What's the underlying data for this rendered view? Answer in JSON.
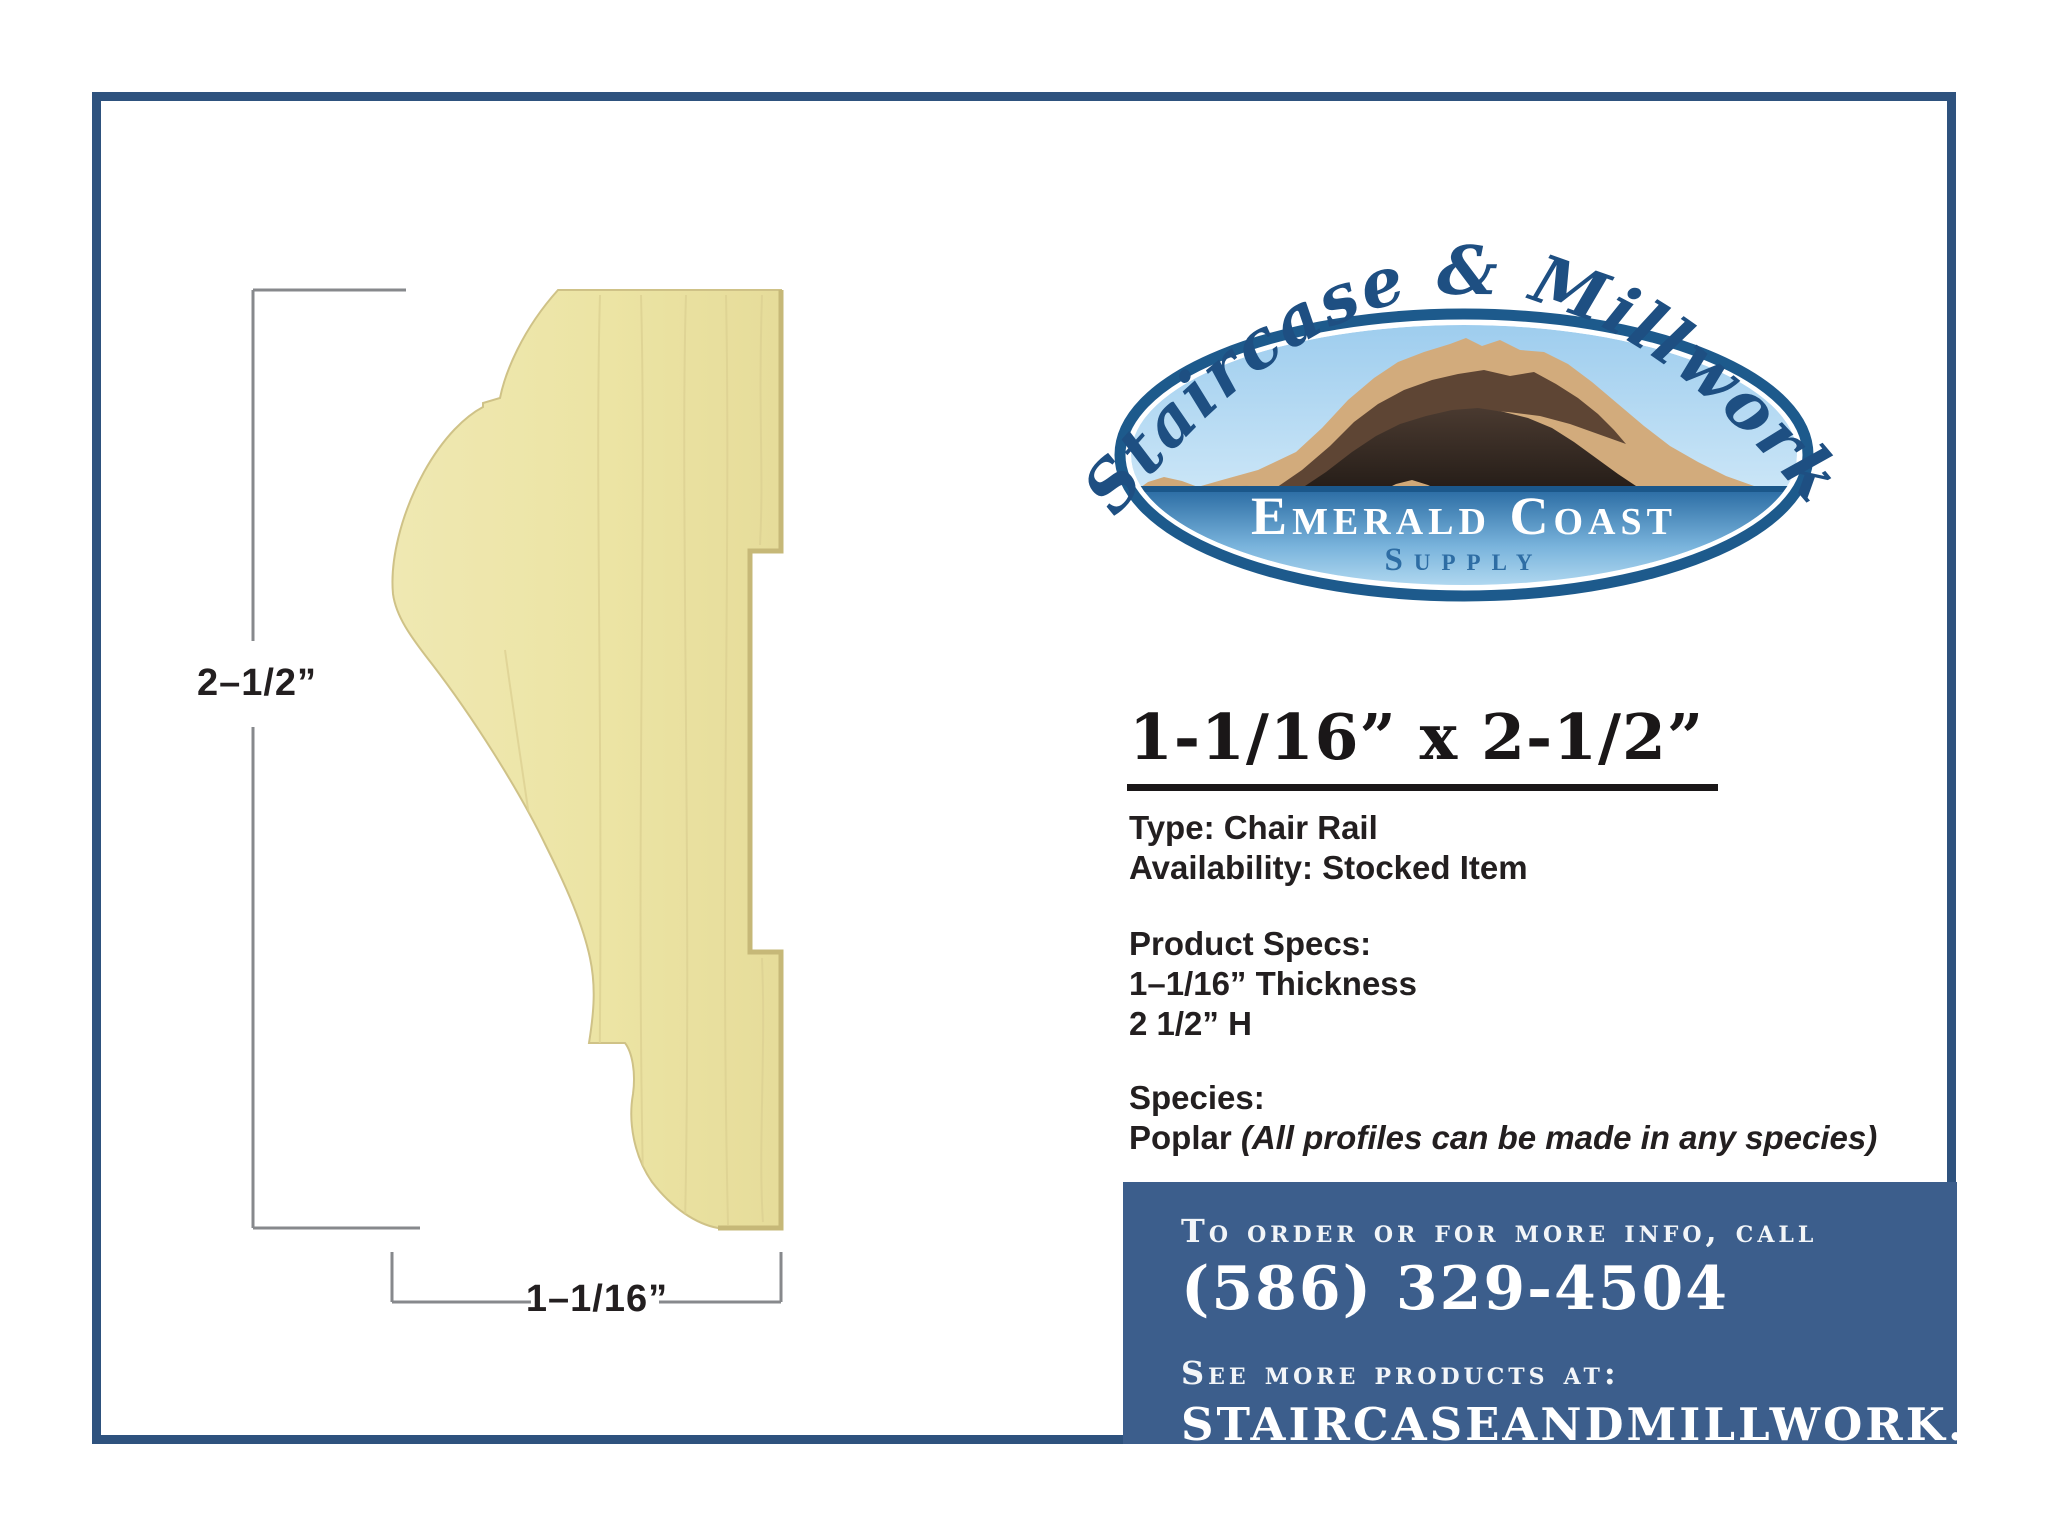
{
  "frame": {
    "border_color": "#2e527e"
  },
  "drawing": {
    "height_label": "2–1/2”",
    "width_label": "1–1/16”",
    "wood_color": "#ece4a4",
    "dimension_line_color": "#87898c"
  },
  "logo": {
    "script_text": "Staircase & Millwork",
    "script_color": "#1e4f82",
    "emblem_title": "Emerald Coast",
    "emblem_subtitle": "Supply",
    "ring_color": "#1d5a8c"
  },
  "product": {
    "title": "1-1/16” x 2-1/2”",
    "type_line": "Type: Chair Rail",
    "availability_line": "Availability: Stocked Item",
    "specs_heading": "Product Specs:",
    "spec_thickness": "1–1/16” Thickness",
    "spec_height": "2 1/2” H",
    "species_heading": "Species:",
    "species_value": "Poplar ",
    "species_note": "(All profiles can be made in any species)"
  },
  "contact": {
    "box_color": "#3c5e8c",
    "order_heading": "To order or for more info, call",
    "phone": "(586) 329-4504",
    "see_more": "See more products at:",
    "website": "STAIRCASEANDMILLWORK.COM"
  }
}
